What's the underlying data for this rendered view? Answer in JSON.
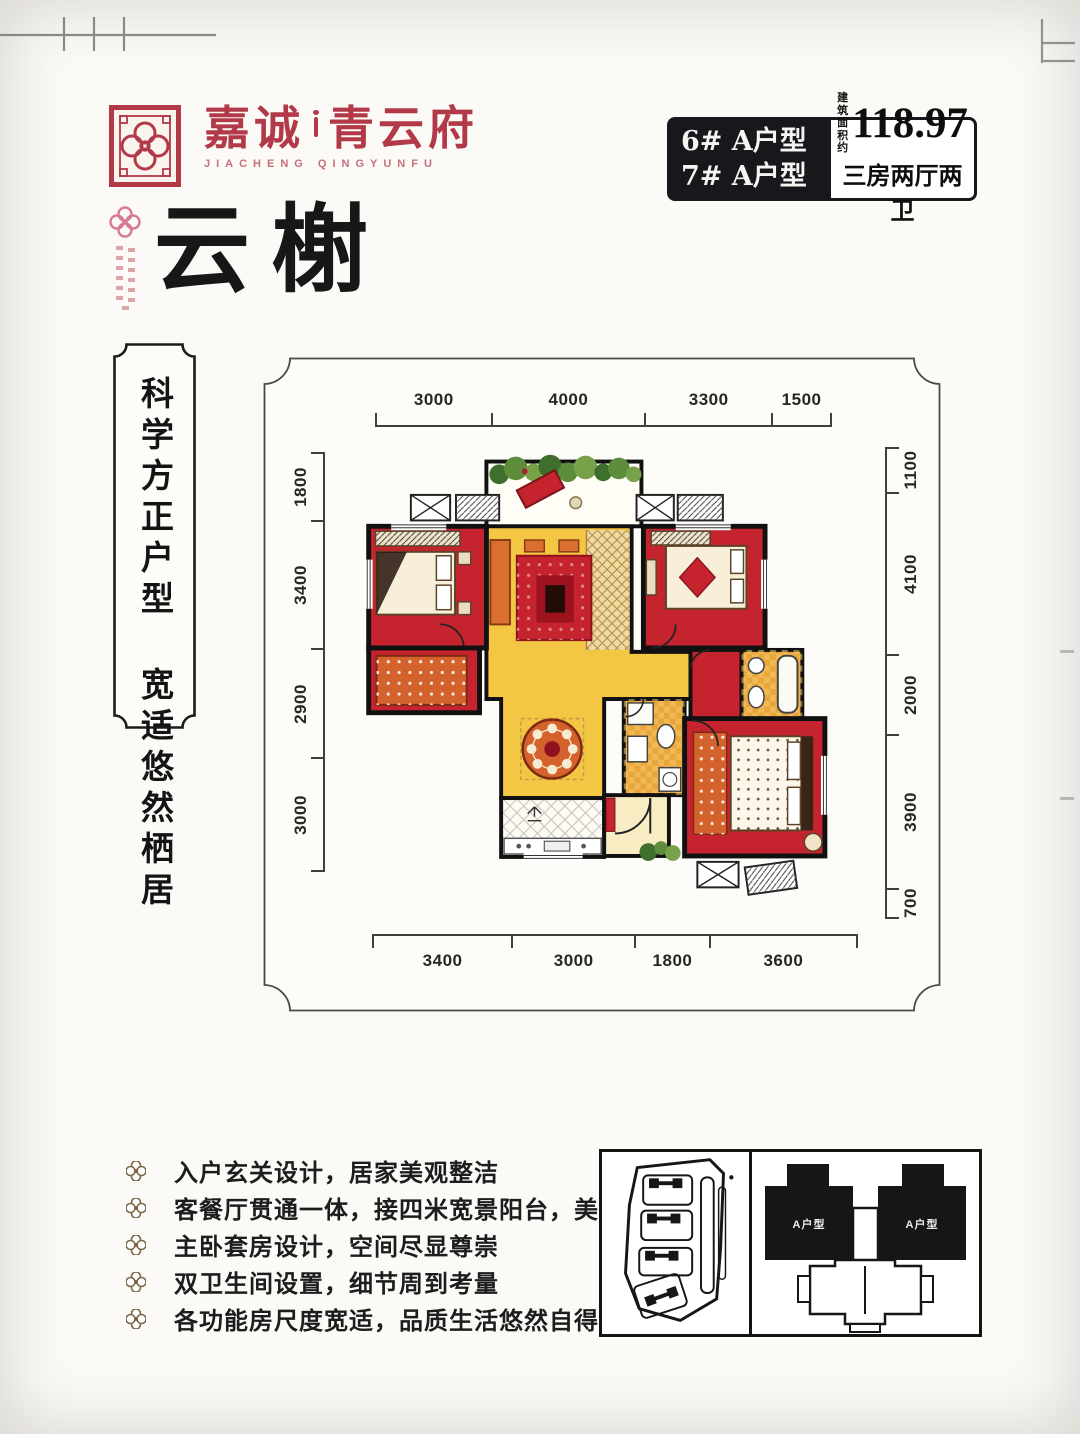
{
  "brand": {
    "name_left": "嘉诚",
    "name_right": "青云府",
    "name_en": "JIACHENG QINGYUNFU"
  },
  "spec": {
    "unit_line1": "6# A户型",
    "unit_line2": "7# A户型",
    "area_label_line1": "建筑",
    "area_label_line2": "面积约",
    "area_value": "118.97",
    "layout": "三房两厅两卫"
  },
  "title": {
    "name": "云榭"
  },
  "banner": {
    "line1": "科学方正户型",
    "line2": "宽适悠然栖居"
  },
  "floorplan": {
    "dims_top": [
      "3000",
      "4000",
      "3300",
      "1500"
    ],
    "dims_left": [
      "1800",
      "3400",
      "2900",
      "3000"
    ],
    "dims_right": [
      "1100",
      "4100",
      "2000",
      "3900",
      "700"
    ],
    "dims_bottom": [
      "3400",
      "3000",
      "1800",
      "3600"
    ]
  },
  "features": {
    "items": [
      "入户玄关设计，居家美观整洁",
      "客餐厅贯通一体，接四米宽景阳台，美景尽现",
      "主卧套房设计，空间尽显尊崇",
      "双卫生间设置，细节周到考量",
      "各功能房尺度宽适，品质生活悠然自得"
    ]
  },
  "keyplan": {
    "unit_label": "A户型"
  },
  "colors": {
    "brand_red": "#b23a48",
    "spec_black": "#17171c",
    "room_red": "#c5242f",
    "living_yellow": "#f3c643",
    "bath_orange": "#e9a63a"
  }
}
